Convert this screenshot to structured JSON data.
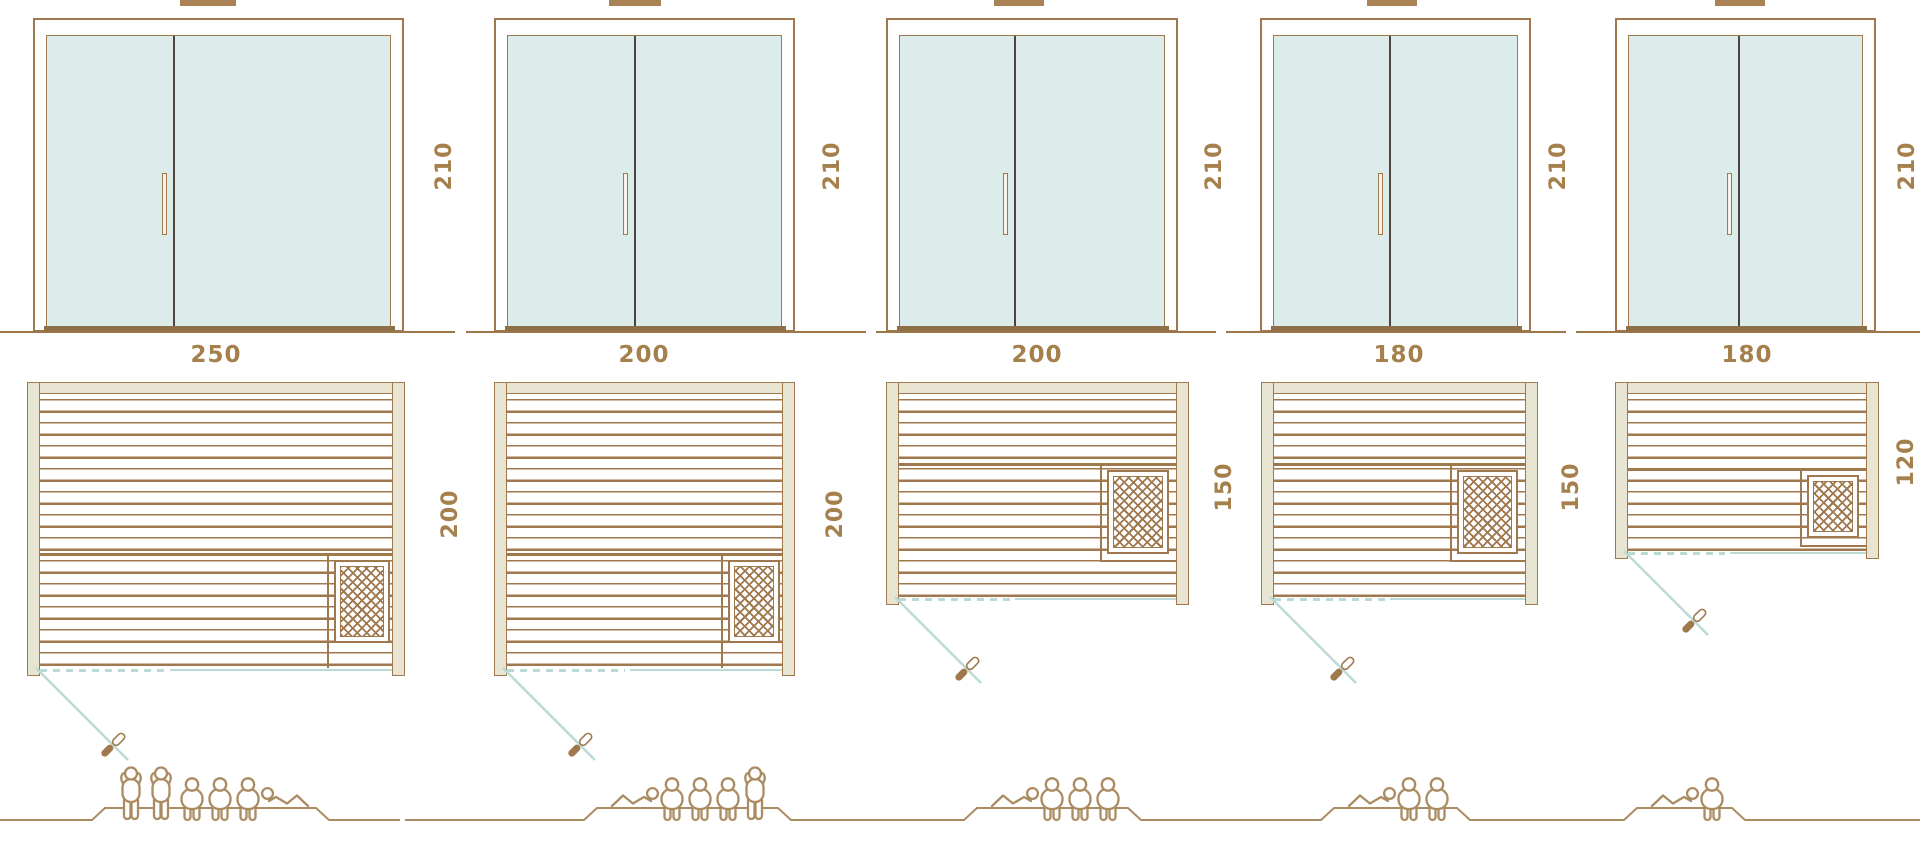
{
  "saunas": [
    {
      "name": "sauna-250x200",
      "door_height": "210",
      "plan_width": "250",
      "plan_depth": "200",
      "capacity": 6,
      "capacity_figures": [
        "standing",
        "standing",
        "seated",
        "seated",
        "seated",
        "lying-right"
      ]
    },
    {
      "name": "sauna-200x200",
      "door_height": "210",
      "plan_width": "200",
      "plan_depth": "200",
      "capacity": 5,
      "capacity_figures": [
        "lying-left",
        "seated",
        "seated",
        "seated",
        "standing"
      ]
    },
    {
      "name": "sauna-200x150",
      "door_height": "210",
      "plan_width": "200",
      "plan_depth": "150",
      "capacity": 4,
      "capacity_figures": [
        "lying-left",
        "seated",
        "seated",
        "seated"
      ]
    },
    {
      "name": "sauna-180x150",
      "door_height": "210",
      "plan_width": "180",
      "plan_depth": "150",
      "capacity": 3,
      "capacity_figures": [
        "lying-left",
        "seated",
        "seated"
      ]
    },
    {
      "name": "sauna-180x120",
      "door_height": "210",
      "plan_width": "180",
      "plan_depth": "120",
      "capacity": 2,
      "capacity_figures": [
        "lying-left",
        "seated"
      ]
    }
  ],
  "icons": {
    "heater": "heater-lattice-icon",
    "door_swing": "door-swing-line-icon",
    "door_handle": "door-handle-icon",
    "capacity_figure_types": [
      "standing",
      "seated",
      "lying"
    ]
  },
  "colors": {
    "line_brown": "#a0784d",
    "label_brown": "#a5804c",
    "wall_beige": "#e7e4d2",
    "glass_teal": "#dcecea",
    "glass_front_blue": "#bcdad5",
    "figure_outline": "#ab8c62",
    "divider_dark": "#4e463e"
  }
}
